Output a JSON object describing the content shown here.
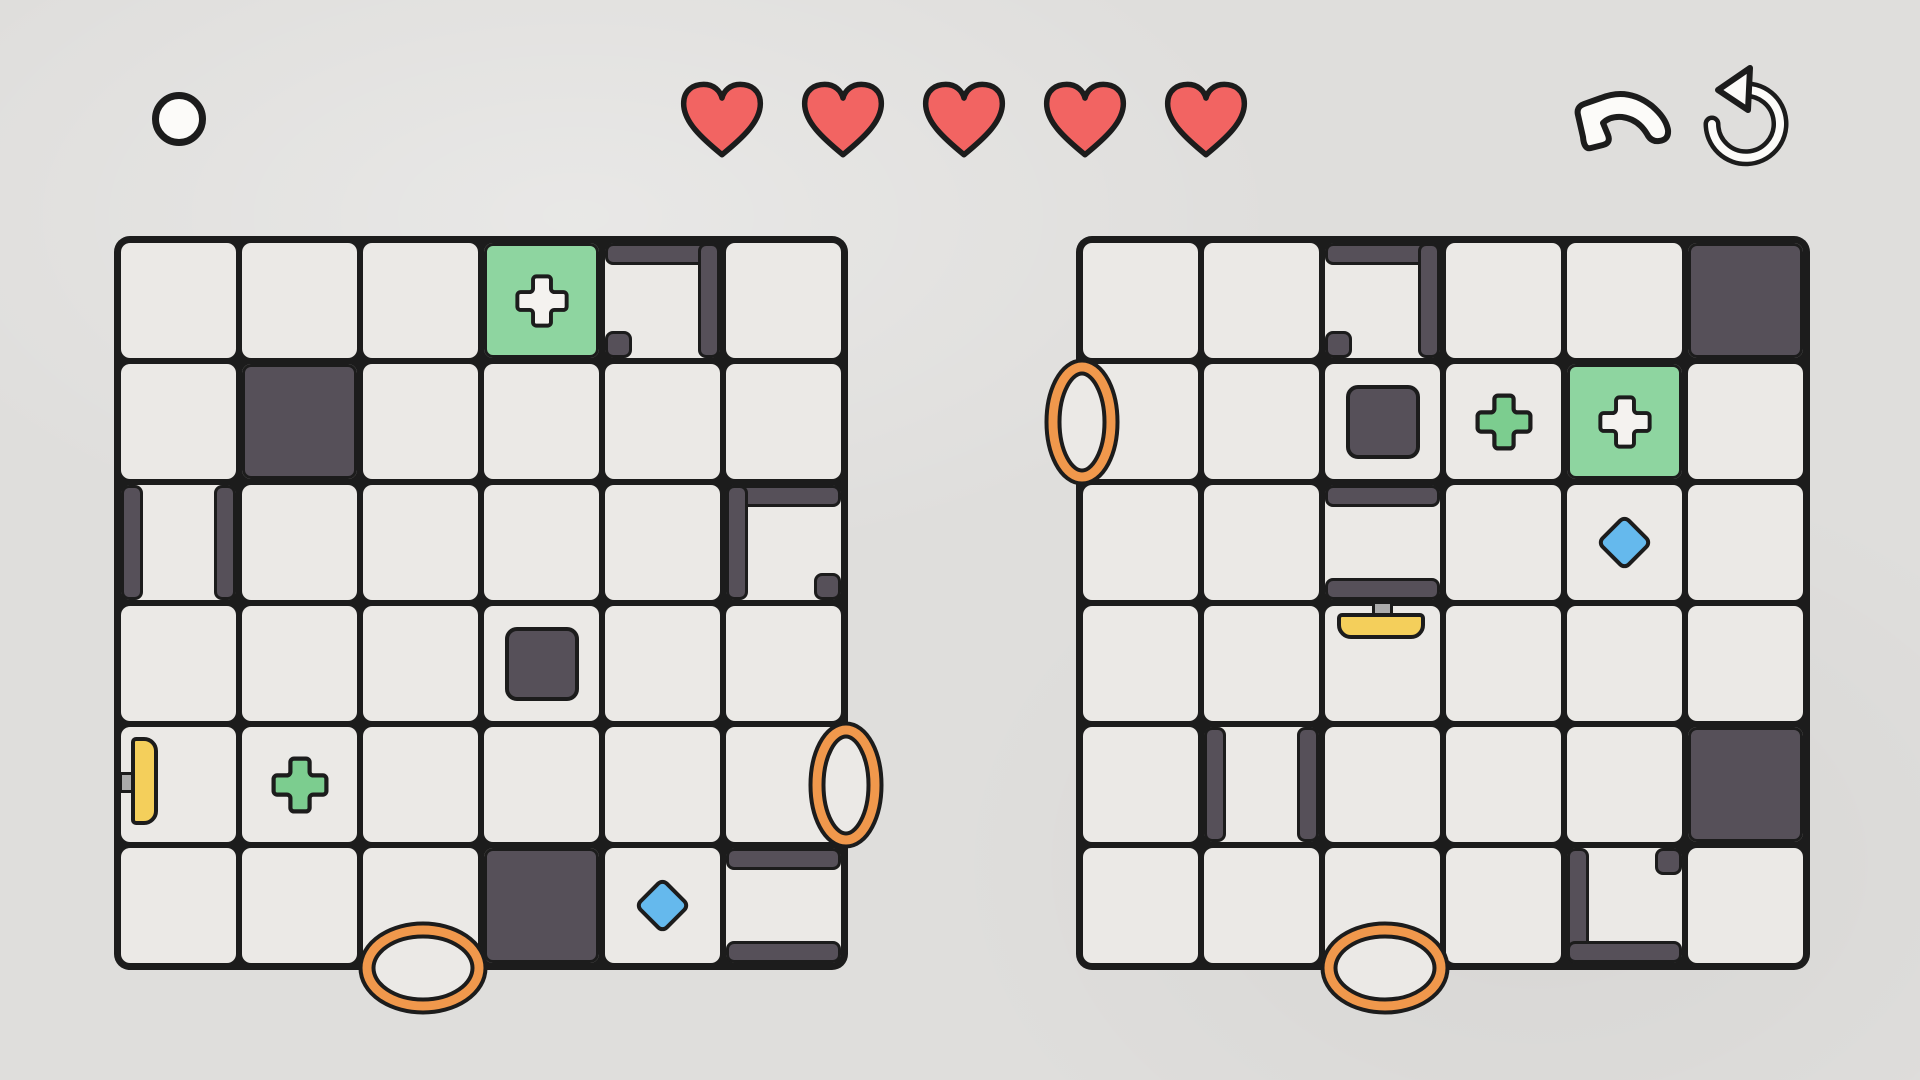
{
  "hud": {
    "lives": 5,
    "white_circle": {
      "x": 152,
      "y": 92,
      "size": 54
    },
    "lives_bar": {
      "x": 676,
      "y": 78,
      "heart_w": 92,
      "heart_h": 84,
      "gap": 29
    },
    "undo_button": {
      "x": 1572,
      "y": 88
    },
    "restart_button": {
      "x": 1694,
      "y": 60
    }
  },
  "colors": {
    "background": "#dfdedc",
    "cell": "#ebe9e6",
    "line": "#1c1c1c",
    "wall": "#565059",
    "goal_green": "#8ed5a0",
    "pickup_green": "#7ccd8f",
    "plus_white": "#f4f2ef",
    "paddle_yellow": "#f4cf5b",
    "stem_gray": "#ababab",
    "gem_blue": "#65b9ed",
    "portal_orange": "#f0984c",
    "heart_red": "#f26462",
    "icon_white": "#fcfbf9"
  },
  "boards": [
    {
      "name": "left-board",
      "x": 118,
      "y": 240,
      "cols": 6,
      "rows": 6,
      "cell": 121,
      "goals": [
        {
          "r": 0,
          "c": 3
        }
      ],
      "solids": [
        {
          "r": 1,
          "c": 1
        },
        {
          "r": 5,
          "c": 3
        }
      ],
      "blocks": [
        {
          "r": 3,
          "c": 3
        }
      ],
      "walls": [
        {
          "r": 0,
          "c": 4,
          "e": "top"
        },
        {
          "r": 0,
          "c": 4,
          "e": "right"
        },
        {
          "r": 2,
          "c": 0,
          "e": "left"
        },
        {
          "r": 2,
          "c": 0,
          "e": "right"
        },
        {
          "r": 2,
          "c": 5,
          "e": "top"
        },
        {
          "r": 2,
          "c": 5,
          "e": "left"
        },
        {
          "r": 5,
          "c": 5,
          "e": "top"
        },
        {
          "r": 5,
          "c": 5,
          "e": "bottom"
        }
      ],
      "nubs": [
        {
          "r": 0,
          "c": 4,
          "corner": "bl"
        },
        {
          "r": 2,
          "c": 5,
          "corner": "br"
        }
      ],
      "pluses": [
        {
          "r": 4,
          "c": 1
        }
      ],
      "gems": [
        {
          "r": 5,
          "c": 4
        }
      ],
      "portals": [
        {
          "r": 4,
          "c": 5,
          "side": "right"
        },
        {
          "r": 5,
          "c": 2,
          "side": "bottom"
        }
      ],
      "paddles": [
        {
          "r": 4,
          "c": 0,
          "side": "left"
        }
      ]
    },
    {
      "name": "right-board",
      "x": 1080,
      "y": 240,
      "cols": 6,
      "rows": 6,
      "cell": 121,
      "goals": [
        {
          "r": 1,
          "c": 4
        }
      ],
      "solids": [
        {
          "r": 0,
          "c": 5
        },
        {
          "r": 4,
          "c": 5
        }
      ],
      "blocks": [
        {
          "r": 1,
          "c": 2
        }
      ],
      "walls": [
        {
          "r": 0,
          "c": 2,
          "e": "top"
        },
        {
          "r": 0,
          "c": 2,
          "e": "right"
        },
        {
          "r": 2,
          "c": 2,
          "e": "top"
        },
        {
          "r": 2,
          "c": 2,
          "e": "bottom"
        },
        {
          "r": 4,
          "c": 1,
          "e": "left"
        },
        {
          "r": 4,
          "c": 1,
          "e": "right"
        },
        {
          "r": 5,
          "c": 4,
          "e": "left"
        },
        {
          "r": 5,
          "c": 4,
          "e": "bottom"
        }
      ],
      "nubs": [
        {
          "r": 0,
          "c": 2,
          "corner": "bl"
        },
        {
          "r": 5,
          "c": 4,
          "corner": "tr"
        }
      ],
      "pluses": [
        {
          "r": 1,
          "c": 3
        }
      ],
      "gems": [
        {
          "r": 2,
          "c": 4
        }
      ],
      "portals": [
        {
          "r": 1,
          "c": 0,
          "side": "left"
        },
        {
          "r": 5,
          "c": 2,
          "side": "bottom"
        }
      ],
      "paddles": [
        {
          "r": 3,
          "c": 2,
          "side": "top"
        }
      ]
    }
  ]
}
